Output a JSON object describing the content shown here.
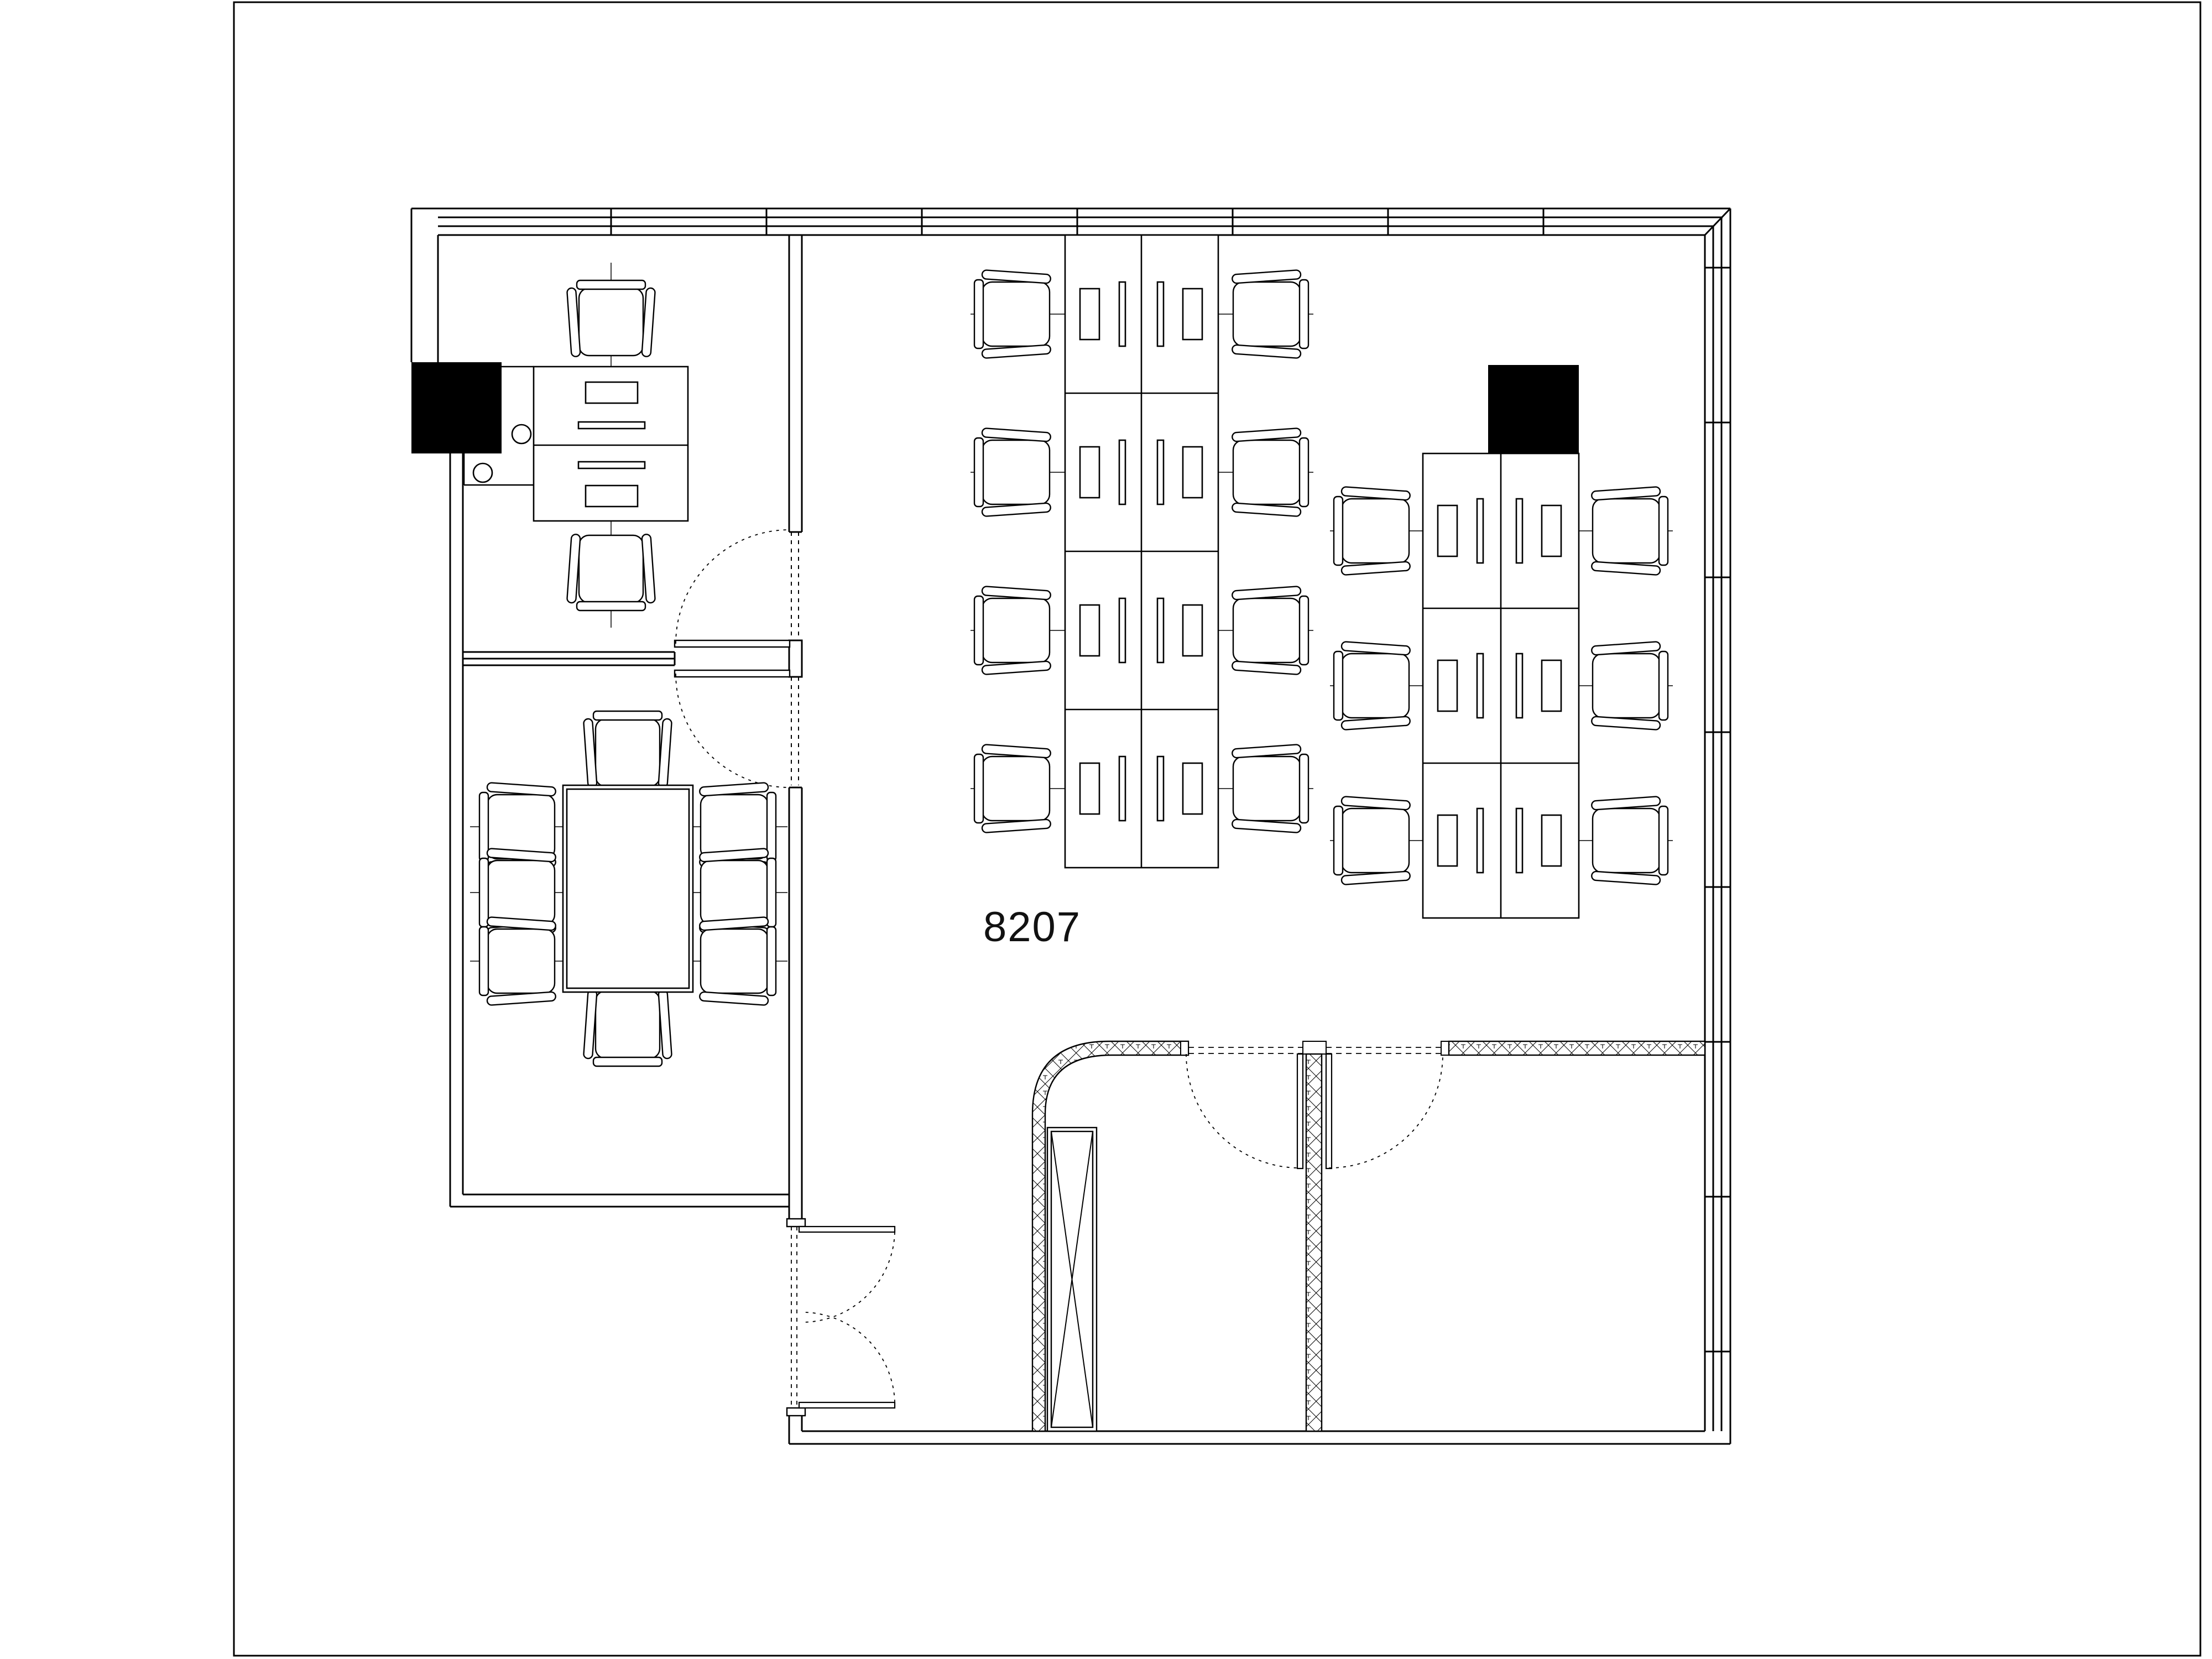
{
  "sheet": {
    "room_label": "8207",
    "colors": {
      "line": "#000000",
      "background": "#ffffff",
      "column_fill": "#000000"
    }
  },
  "counts": {
    "structural_columns": 2,
    "office_chairs": 24,
    "open_plan_workstations": 14,
    "private_office_desks": 2,
    "conference_tables": 1,
    "door_leaves": 6,
    "duct_shafts": 1
  },
  "symbols": {
    "chair": "armchair-top-view-icon",
    "workstation": "desk-with-monitor-keyboard-icon",
    "column": "filled-square-column-icon",
    "door": "quarter-circle-swing-door-icon",
    "shaft": "x-braced-duct-shaft-icon",
    "insulated_wall": "diamond-hatch-wall-pattern"
  }
}
